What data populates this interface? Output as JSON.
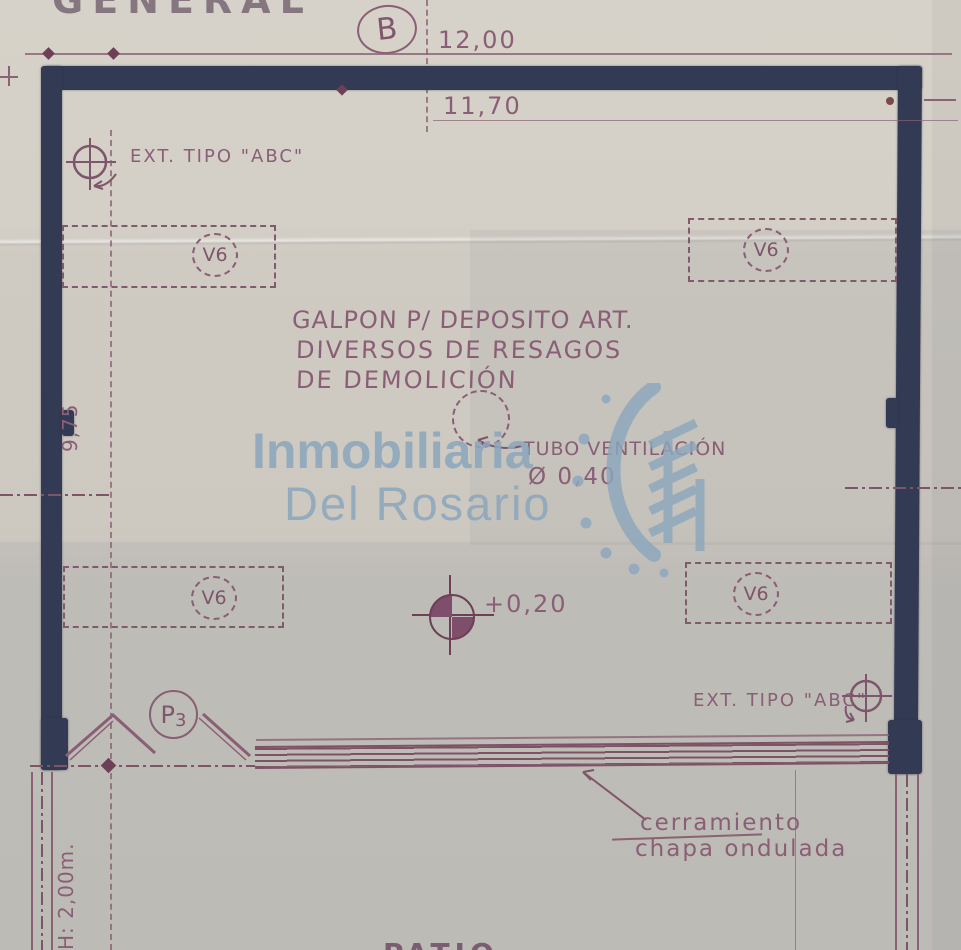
{
  "sheet": {
    "caption": "GENERAL",
    "axis_bubble": "B",
    "patio": "PATIO"
  },
  "dimensions": {
    "overall_width": "12,00",
    "inner_width": "11,70",
    "left_height": "9,75",
    "level_mark": "+0,20",
    "vent_diameter": "Ø 0,40",
    "door_height_note": "H: 2,00m."
  },
  "labels": {
    "ext_top": "EXT. TIPO \"ABC\"",
    "ext_bottom": "EXT. TIPO \"ABC\"",
    "title_line1": "GALPON P/ DEPOSITO ART.",
    "title_line2": "DIVERSOS DE RESAGOS",
    "title_line3": "DE DEMOLICIÓN",
    "vent": "TUBO VENTILACIÓN",
    "closure_line1": "cerramiento",
    "closure_line2": "chapa ondulada"
  },
  "tags": {
    "window": "V6",
    "door_letter": "P",
    "door_number": "3"
  },
  "watermark": {
    "line1": "Inmobiliaria",
    "line2": "Del Rosario",
    "color": "#8ca7bd"
  },
  "colors": {
    "paper": "#cdc9c1",
    "wall_ink": "#333a53",
    "drawing_ink": "#8a5e76",
    "watermark_blue": "#8ca7bd"
  }
}
